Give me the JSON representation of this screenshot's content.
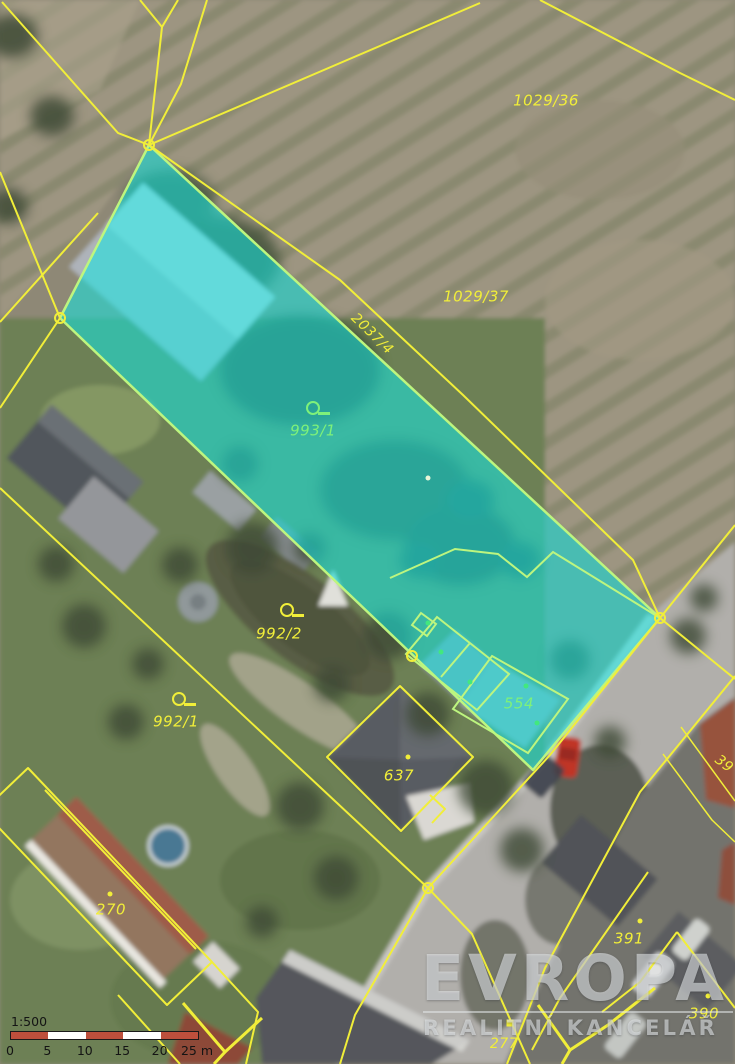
{
  "map": {
    "type": "cadastral-parcel-map-on-aerial-photo",
    "colors": {
      "boundary_line": "#f1ee39",
      "highlight_fill": "#10e8e4",
      "highlight_edge": "#bdf57f",
      "label_yellow": "#f1ee39",
      "label_green": "#7ef17a"
    },
    "parcel_labels": [
      {
        "text": "1029/36",
        "x": 546,
        "y": 101,
        "color": "yellow",
        "size": 15
      },
      {
        "text": "1029/37",
        "x": 476,
        "y": 297,
        "color": "yellow",
        "size": 15
      },
      {
        "text": "2037/4",
        "x": 372,
        "y": 334,
        "color": "yellow",
        "size": 14,
        "rotate": 44
      },
      {
        "text": "993/1",
        "x": 313,
        "y": 431,
        "color": "green",
        "size": 15,
        "symbol": "circle-flag",
        "sx": 313,
        "sy": 408
      },
      {
        "text": "992/2",
        "x": 279,
        "y": 634,
        "color": "yellow",
        "size": 15,
        "symbol": "circle-flag",
        "sx": 287,
        "sy": 610
      },
      {
        "text": "992/1",
        "x": 176,
        "y": 722,
        "color": "yellow",
        "size": 15,
        "symbol": "circle-flag",
        "sx": 179,
        "sy": 699
      },
      {
        "text": "554",
        "x": 519,
        "y": 704,
        "color": "green",
        "size": 15
      },
      {
        "text": "637",
        "x": 399,
        "y": 776,
        "color": "yellow",
        "size": 15
      },
      {
        "text": "270",
        "x": 111,
        "y": 910,
        "color": "yellow",
        "size": 15
      },
      {
        "text": "391",
        "x": 629,
        "y": 939,
        "color": "yellow",
        "size": 15
      },
      {
        "text": "390",
        "x": 704,
        "y": 1014,
        "color": "yellow",
        "size": 15
      },
      {
        "text": "277",
        "x": 504,
        "y": 1044,
        "color": "yellow",
        "size": 14
      },
      {
        "text": "39",
        "x": 724,
        "y": 764,
        "color": "yellow",
        "size": 14,
        "rotate": 38
      }
    ],
    "markers": [
      {
        "type": "vertex",
        "x": 149,
        "y": 145
      },
      {
        "type": "vertex",
        "x": 60,
        "y": 318
      },
      {
        "type": "vertex",
        "x": 660,
        "y": 618
      },
      {
        "type": "vertex",
        "x": 412,
        "y": 656
      },
      {
        "type": "vertex",
        "x": 428,
        "y": 888
      },
      {
        "type": "dot",
        "color": "#f1ee39",
        "x": 408,
        "y": 757
      },
      {
        "type": "dot",
        "color": "#f1ee39",
        "x": 110,
        "y": 894
      },
      {
        "type": "dot",
        "color": "#f1ee39",
        "x": 640,
        "y": 921
      },
      {
        "type": "dot",
        "color": "#f1ee39",
        "x": 708,
        "y": 996
      },
      {
        "type": "square",
        "color": "#f1ee39",
        "x": 510,
        "y": 1023
      },
      {
        "type": "dot",
        "color": "#42e87e",
        "x": 441,
        "y": 652
      },
      {
        "type": "dot",
        "color": "#42e87e",
        "x": 470,
        "y": 682
      },
      {
        "type": "dot",
        "color": "#42e87e",
        "x": 526,
        "y": 686
      },
      {
        "type": "dot",
        "color": "#42e87e",
        "x": 537,
        "y": 723
      },
      {
        "type": "dot",
        "color": "#42e87e",
        "x": 428,
        "y": 623
      },
      {
        "type": "dot",
        "color": "#e8f5d8",
        "x": 428,
        "y": 478
      }
    ],
    "scale": {
      "ratio": "1:500",
      "unit_ticks": [
        "0",
        "5",
        "10",
        "15",
        "20",
        "25 m"
      ],
      "segment_colors": [
        "#bd4f3c",
        "#ffffff",
        "#bd4f3c",
        "#ffffff",
        "#bd4f3c"
      ]
    },
    "watermark": {
      "title": "EVROPA",
      "subtitle": "REALITNÍ KANCELÁŘ"
    }
  }
}
